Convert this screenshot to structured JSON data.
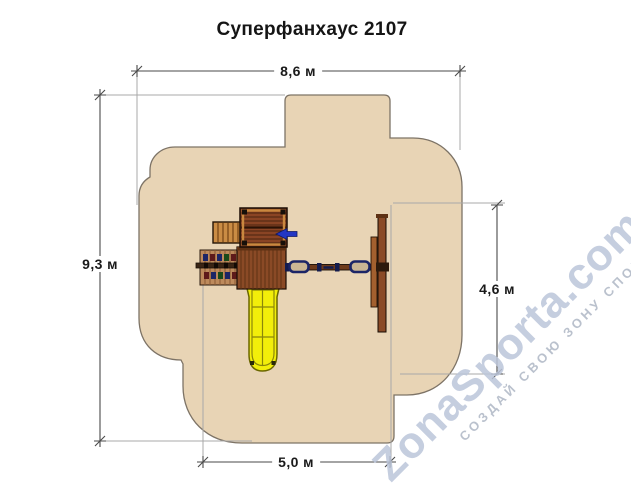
{
  "title": "Суперфанхаус 2107",
  "dimensions": {
    "total_width": "8,6 м",
    "total_height": "9,3 м",
    "swing_zone_height": "4,6 м",
    "bottom_zone_width": "5,0 м"
  },
  "watermark": {
    "text": "ZonaSporta.com",
    "slogan": "СОЗДАЙ СВОЮ ЗОНУ СПОРТА"
  },
  "colors": {
    "safety_zone_fill": "#e8d4b5",
    "safety_zone_outline": "#7d7366",
    "wood_light": "#ca8c44",
    "wood_panel": "#bd8a5c",
    "wood_mid": "#8a4a26",
    "wood_dark": "#8a4424",
    "slide_yellow": "#f2ee0a",
    "flag_blue": "#2336c4",
    "seat_navy": "#1c2566",
    "dimension_line": "#4a4a4a",
    "extension_line": "#a9a9a9",
    "title_text": "#151515",
    "watermark_text": "#bcc6da",
    "watermark_slogan": "#aeb7c5"
  }
}
